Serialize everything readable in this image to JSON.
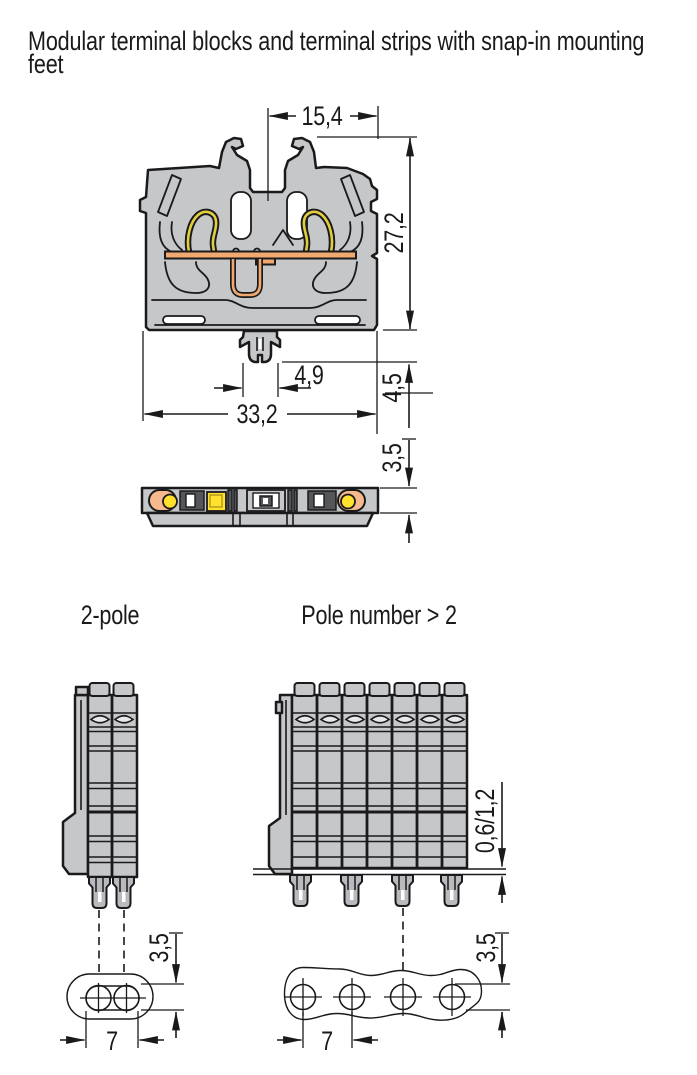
{
  "title_lines": [
    "Modular terminal blocks and terminal strips with snap-in mounting",
    "feet"
  ],
  "front_view": {
    "dim_top_width": "15,4",
    "dim_block_height": "27,2",
    "dim_foot_width": "4,9",
    "dim_foot_height": "4,5",
    "dim_block_width": "33,2",
    "dim_base_height": "3,5"
  },
  "bottom_views": {
    "two_pole": {
      "label": "2-pole",
      "dim_slot_length": "7",
      "dim_slot_width": "3,5"
    },
    "multi_pole": {
      "label": "Pole number > 2",
      "dim_hole_pitch": "7",
      "dim_hole_diameter": "3,5",
      "dim_plate_thickness": "0,6/1,2"
    }
  },
  "colors": {
    "background": "#ffffff",
    "body_gray": "#c6c7c9",
    "outline_black": "#1a1a1c",
    "busbar_orange": "#f2a96f",
    "strip_orange": "#f6b98d",
    "spring_yellow": "#e3cf3e",
    "indicator_yellow": "#ffe12e",
    "slot_dark_gray": "#55565a"
  }
}
